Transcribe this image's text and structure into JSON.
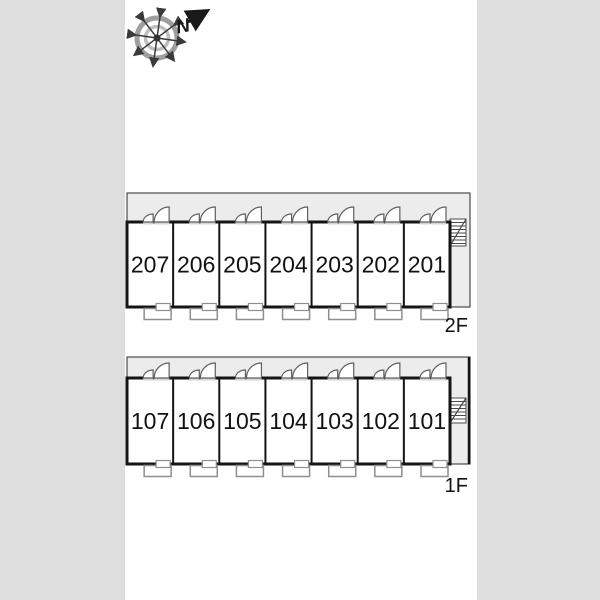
{
  "compass": {
    "north_label": "N"
  },
  "floors": [
    {
      "label": "2F",
      "rooms": [
        "207",
        "206",
        "205",
        "204",
        "203",
        "202",
        "201"
      ]
    },
    {
      "label": "1F",
      "rooms": [
        "107",
        "106",
        "105",
        "104",
        "103",
        "102",
        "101"
      ]
    }
  ],
  "colors": {
    "page_bg": "#dedede",
    "paper": "#ffffff",
    "corridor_fill": "#ececec",
    "wall": "#141414",
    "thin_outline": "#4a4a4a",
    "door_stroke": "#5f5f5f",
    "threshold_fill": "#d4d4d4",
    "balcony_stroke": "#8f8f8f",
    "text": "#111111",
    "compass_ring_outer": "#9e9e9e",
    "compass_ring_inner": "#bfbfbf",
    "compass_spoke": "#3a3a3a"
  }
}
